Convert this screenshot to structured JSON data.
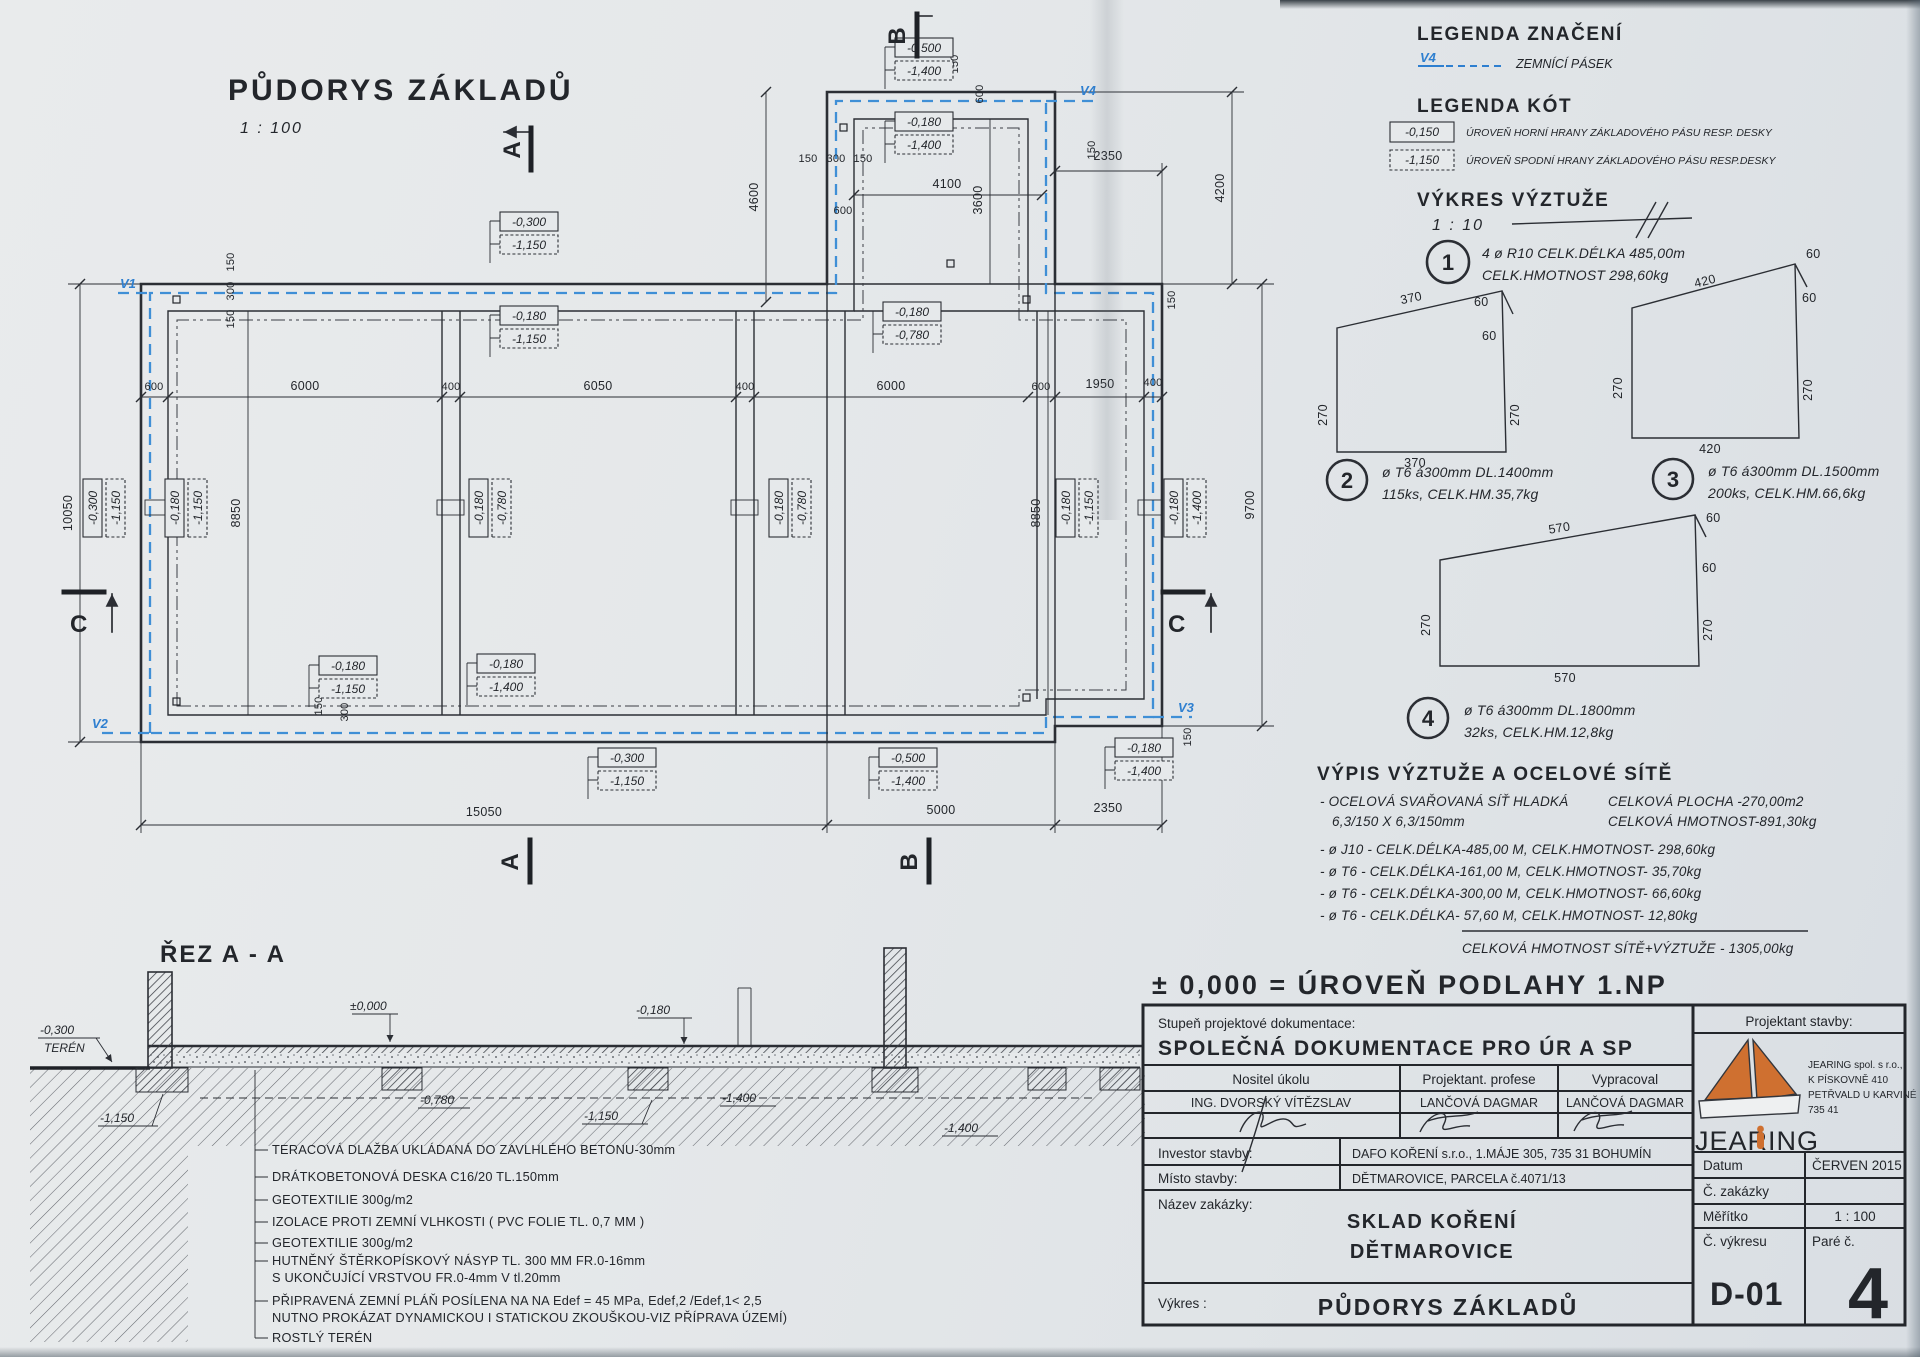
{
  "plan": {
    "title": "PŮDORYS ZÁKLADŮ",
    "scale": "1 : 100",
    "v_labels": [
      "V1",
      "V2",
      "V3",
      "V4"
    ],
    "section_letters": [
      "A",
      "A",
      "B",
      "B",
      "C",
      "C"
    ],
    "dims": {
      "bottom": [
        "15050",
        "5000",
        "2350"
      ],
      "left": [
        "10050"
      ],
      "right": [
        "4200",
        "9700"
      ],
      "top": [
        "2350",
        "4600",
        "4100",
        "3600"
      ],
      "row": [
        "600",
        "6000",
        "400",
        "6050",
        "400",
        "6000",
        "600",
        "1950",
        "400"
      ],
      "vert": [
        "8850",
        "8850"
      ],
      "small": [
        "150",
        "300",
        "150",
        "150",
        "300",
        "150",
        "300",
        "150",
        "150",
        "600",
        "150",
        "600",
        "150",
        "150"
      ]
    },
    "levels": [
      {
        "a": "-0,300",
        "b": "-1,150"
      },
      {
        "a": "-0,180",
        "b": "-1,150"
      },
      {
        "a": "-0,500",
        "b": "-1,400"
      },
      {
        "a": "-0,180",
        "b": "-1,400"
      },
      {
        "a": "-0,180",
        "b": "-0,780"
      },
      {
        "a": "-0,180",
        "b": "-1,150"
      },
      {
        "a": "-0,180",
        "b": "-1,400"
      },
      {
        "a": "-0,300",
        "b": "-1,150"
      },
      {
        "a": "-0,500",
        "b": "-1,400"
      },
      {
        "a": "-0,180",
        "b": "-1,400"
      },
      {
        "a": "-0,300",
        "b": "-1,150"
      },
      {
        "a": "-0,180",
        "b": "-1,150"
      },
      {
        "a": "-0,180",
        "b": "-0,780"
      },
      {
        "a": "-0,180",
        "b": "-0,780"
      },
      {
        "a": "-0,180",
        "b": "-1,150"
      },
      {
        "a": "-0,180",
        "b": "-1,400"
      }
    ]
  },
  "legend_symbols": {
    "title": "LEGENDA ZNAČENÍ",
    "symbol": "V4",
    "label": "ZEMNÍCÍ PÁSEK"
  },
  "legend_levels": {
    "title": "LEGENDA KÓT",
    "items": [
      {
        "value": "-0,150",
        "label": "ÚROVEŇ HORNÍ HRANY ZÁKLADOVÉHO PÁSU RESP. DESKY"
      },
      {
        "value": "-1,150",
        "label": "ÚROVEŇ SPODNÍ HRANY ZÁKLADOVÉHO PÁSU RESP.DESKY"
      }
    ]
  },
  "rebar": {
    "title": "VÝKRES VÝZTUŽE",
    "scale": "1 : 10",
    "details": [
      {
        "no": "1",
        "line1": "4 ø R10 CELK.DÉLKA 485,00m",
        "line2": "CELK.HMOTNOST 298,60kg"
      },
      {
        "no": "2",
        "line1": "ø T6 á300mm DL.1400mm",
        "line2": "115ks, CELK.HM.35,7kg"
      },
      {
        "no": "3",
        "line1": "ø T6 á300mm DL.1500mm",
        "line2": "200ks, CELK.HM.66,6kg"
      },
      {
        "no": "4",
        "line1": "ø T6 á300mm DL.1800mm",
        "line2": "32ks, CELK.HM.12,8kg"
      }
    ],
    "shapes": [
      {
        "top": "370",
        "hook": "60",
        "inner": "60",
        "left": "270",
        "right": "270",
        "bottom": "370"
      },
      {
        "top": "420",
        "hook": "60",
        "inner": "60",
        "left": "270",
        "right": "270",
        "bottom": "420"
      },
      {
        "top": "570",
        "hook": "60",
        "inner": "60",
        "left": "270",
        "right": "270",
        "bottom": "570"
      }
    ]
  },
  "schedule": {
    "title": "VÝPIS VÝZTUŽE A OCELOVÉ SÍTĚ",
    "mesh_line1_left": "- OCELOVÁ SVAŘOVANÁ SÍŤ HLADKÁ",
    "mesh_line1_right": "CELKOVÁ PLOCHA  -270,00m2",
    "mesh_line2_left": "6,3/150 X 6,3/150mm",
    "mesh_line2_right": "CELKOVÁ HMOTNOST-891,30kg",
    "rows": [
      "- ø J10 - CELK.DÉLKA-485,00 M, CELK.HMOTNOST- 298,60kg",
      "- ø T6 - CELK.DÉLKA-161,00 M, CELK.HMOTNOST- 35,70kg",
      "- ø T6 - CELK.DÉLKA-300,00 M, CELK.HMOTNOST- 66,60kg",
      "- ø T6 - CELK.DÉLKA- 57,60 M, CELK.HMOTNOST- 12,80kg"
    ],
    "total_label": "CELKOVÁ HMOTNOST SÍTĚ+VÝZTUŽE",
    "total_value": "-  1305,00kg"
  },
  "level_note": "± 0,000 = ÚROVEŇ PODLAHY 1.NP",
  "section": {
    "title": "ŘEZ A - A",
    "levels": {
      "zero": "±0,000",
      "terrain_a": "-0,300",
      "terrain_b": "TERÉN",
      "m180a": "-0,180",
      "m180b": "-0,180",
      "m780": "-0,780",
      "m1150a": "-1,150",
      "m1150b": "-1,150",
      "m1400a": "-1,400",
      "m1400b": "-1,400"
    },
    "materials": [
      "TERACOVÁ DLAŽBA UKLÁDANÁ DO ZAVLHLÉHO BETONU-30mm",
      "DRÁTKOBETONOVÁ DESKA C16/20 TL.150mm",
      "GEOTEXTILIE  300g/m2",
      "IZOLACE PROTI ZEMNÍ VLHKOSTI ( PVC FOLIE TL. 0,7 MM )",
      "GEOTEXTILIE  300g/m2",
      "HUTNĚNÝ ŠTĚRKOPÍSKOVÝ NÁSYP TL. 300 MM FR.0-16mm",
      "S UKONČUJÍCÍ VRSTVOU FR.0-4mm V tl.20mm",
      "PŘIPRAVENÁ ZEMNÍ PLÁŇ POSÍLENA NA NA Edef = 45 MPa, Edef,2 /Edef,1< 2,5",
      "NUTNO PROKÁZAT DYNAMICKOU I STATICKOU ZKOUŠKOU-VIZ PŘÍPRAVA ÚZEMÍ)",
      "ROSTLÝ TERÉN"
    ]
  },
  "titleblock": {
    "doc_stage_label": "Stupeň projektové dokumentace:",
    "doc_stage": "SPOLEČNÁ DOKUMENTACE PRO ÚR A SP",
    "col_nositel": "Nositel úkolu",
    "col_profese": "Projektant. profese",
    "col_vypracoval": "Vypracoval",
    "name_nositel": "ING. DVORSKÝ VÍTĚZSLAV",
    "name_profese": "LANČOVÁ DAGMAR",
    "name_vypracoval": "LANČOVÁ DAGMAR",
    "investor_label": "Investor stavby:",
    "investor": "DAFO KOŘENÍ s.r.o., 1.MÁJE 305, 735 31 BOHUMÍN",
    "misto_label": "Místo stavby:",
    "misto": "DĚTMAROVICE, PARCELA č.4071/13",
    "nazev_label": "Název zakázky:",
    "nazev_line1": "SKLAD KOŘENÍ",
    "nazev_line2": "DĚTMAROVICE",
    "vykres_label": "Výkres :",
    "vykres": "PŮDORYS ZÁKLADŮ",
    "projektant_label": "Projektant stavby:",
    "logo_text": "JEARING",
    "company_line1": "JEARING spol. s r.o.,",
    "company_line2": "K PÍSKOVNĚ 410",
    "company_line3": "PETŘVALD U KARVINÉ",
    "company_line4": "735 41",
    "datum_label": "Datum",
    "datum": "ČERVEN 2015",
    "zakazka_label": "Č. zakázky",
    "zakazka": "",
    "meritko_label": "Měřítko",
    "meritko": "1 : 100",
    "cvykresu_label": "Č. výkresu",
    "cvykresu": "D-01",
    "pare_label": "Paré č.",
    "pare": "4"
  }
}
